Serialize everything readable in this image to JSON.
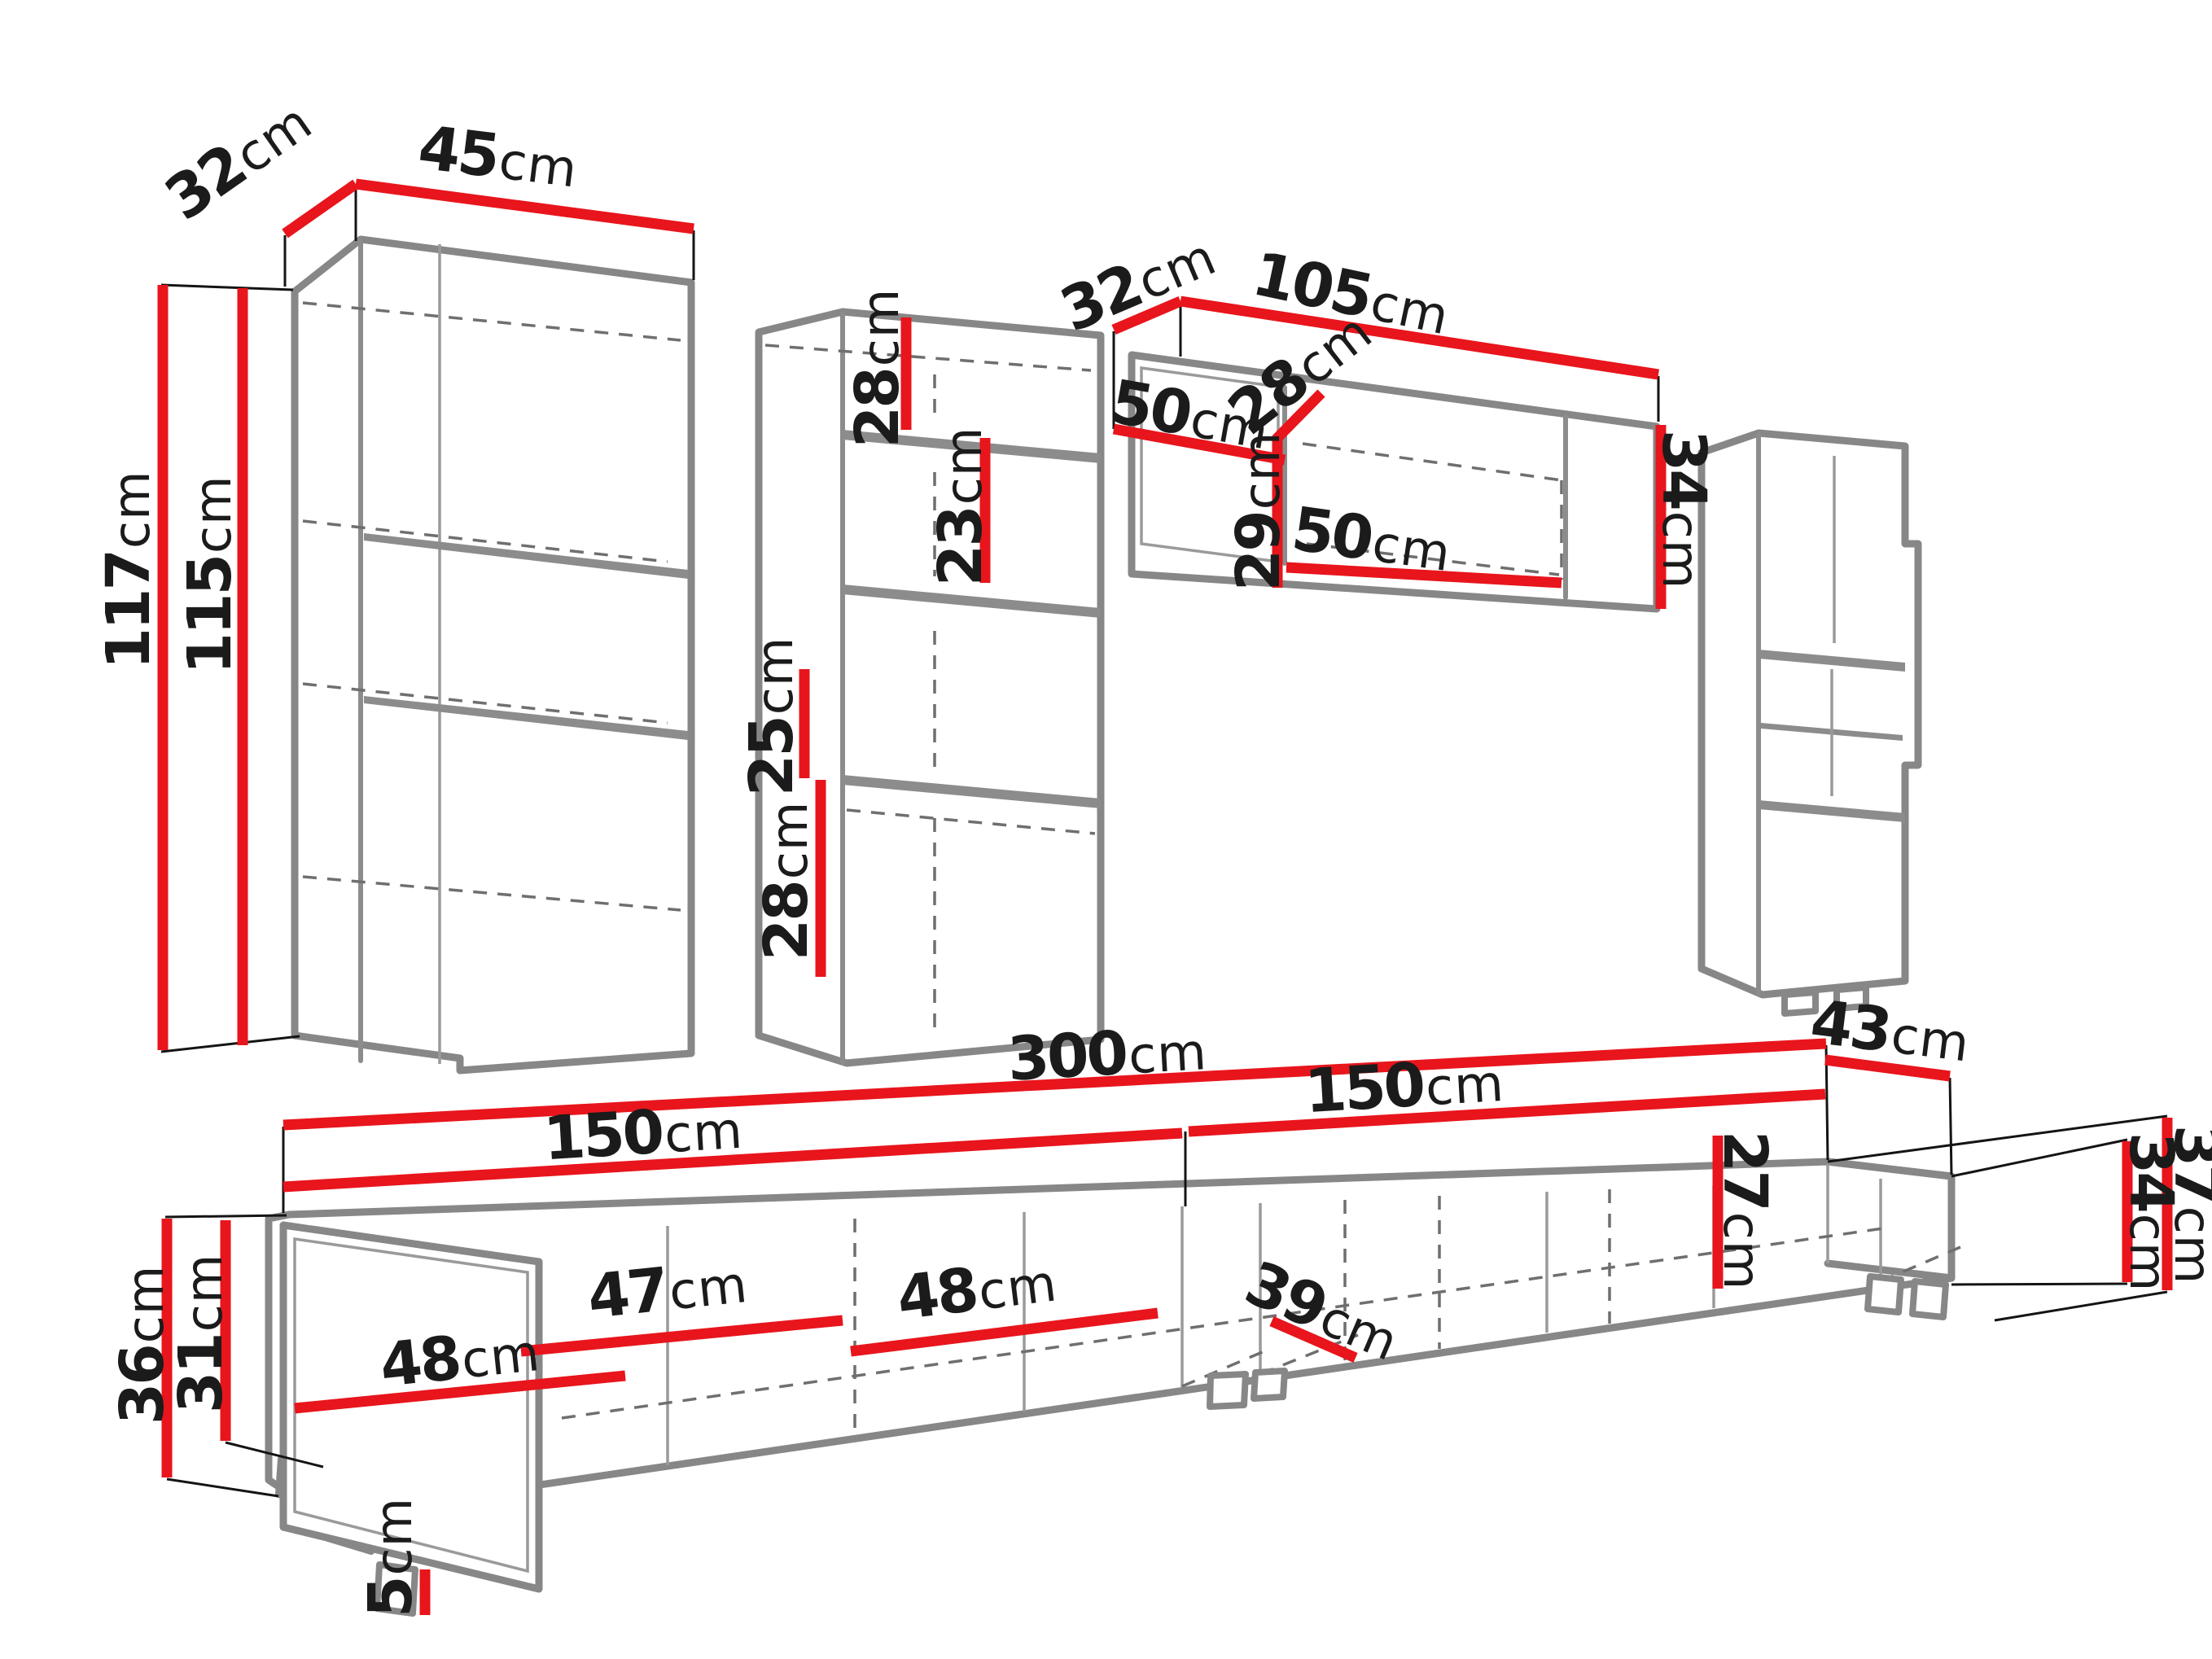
{
  "unit": "cm",
  "diagram": "wall-unit-furniture-dimensions",
  "cabinets": {
    "tall_left": {
      "depth": "32",
      "width": "45",
      "total_height": "117",
      "front_height": "115"
    },
    "middle_column": {
      "top_compartment": "28",
      "upper_shelf": "23",
      "middle_compartment": "25",
      "bottom_compartment": "28"
    },
    "top_wall_unit": {
      "depth": "32",
      "width": "105",
      "left_compartment": "50",
      "inner_depth": "28",
      "inner_height": "29",
      "right_compartment": "50",
      "side_height": "34"
    },
    "tv_stand": {
      "total_width": "300",
      "left_half": "150",
      "right_half": "150",
      "end_depth": "43",
      "right_total_height": "37",
      "right_body_height": "34",
      "inner_height": "27",
      "inner_depth": "39",
      "compartment_a": "48",
      "compartment_b": "47",
      "compartment_c": "48",
      "left_total_height": "36",
      "left_body_height": "31",
      "foot_height": "5"
    }
  }
}
